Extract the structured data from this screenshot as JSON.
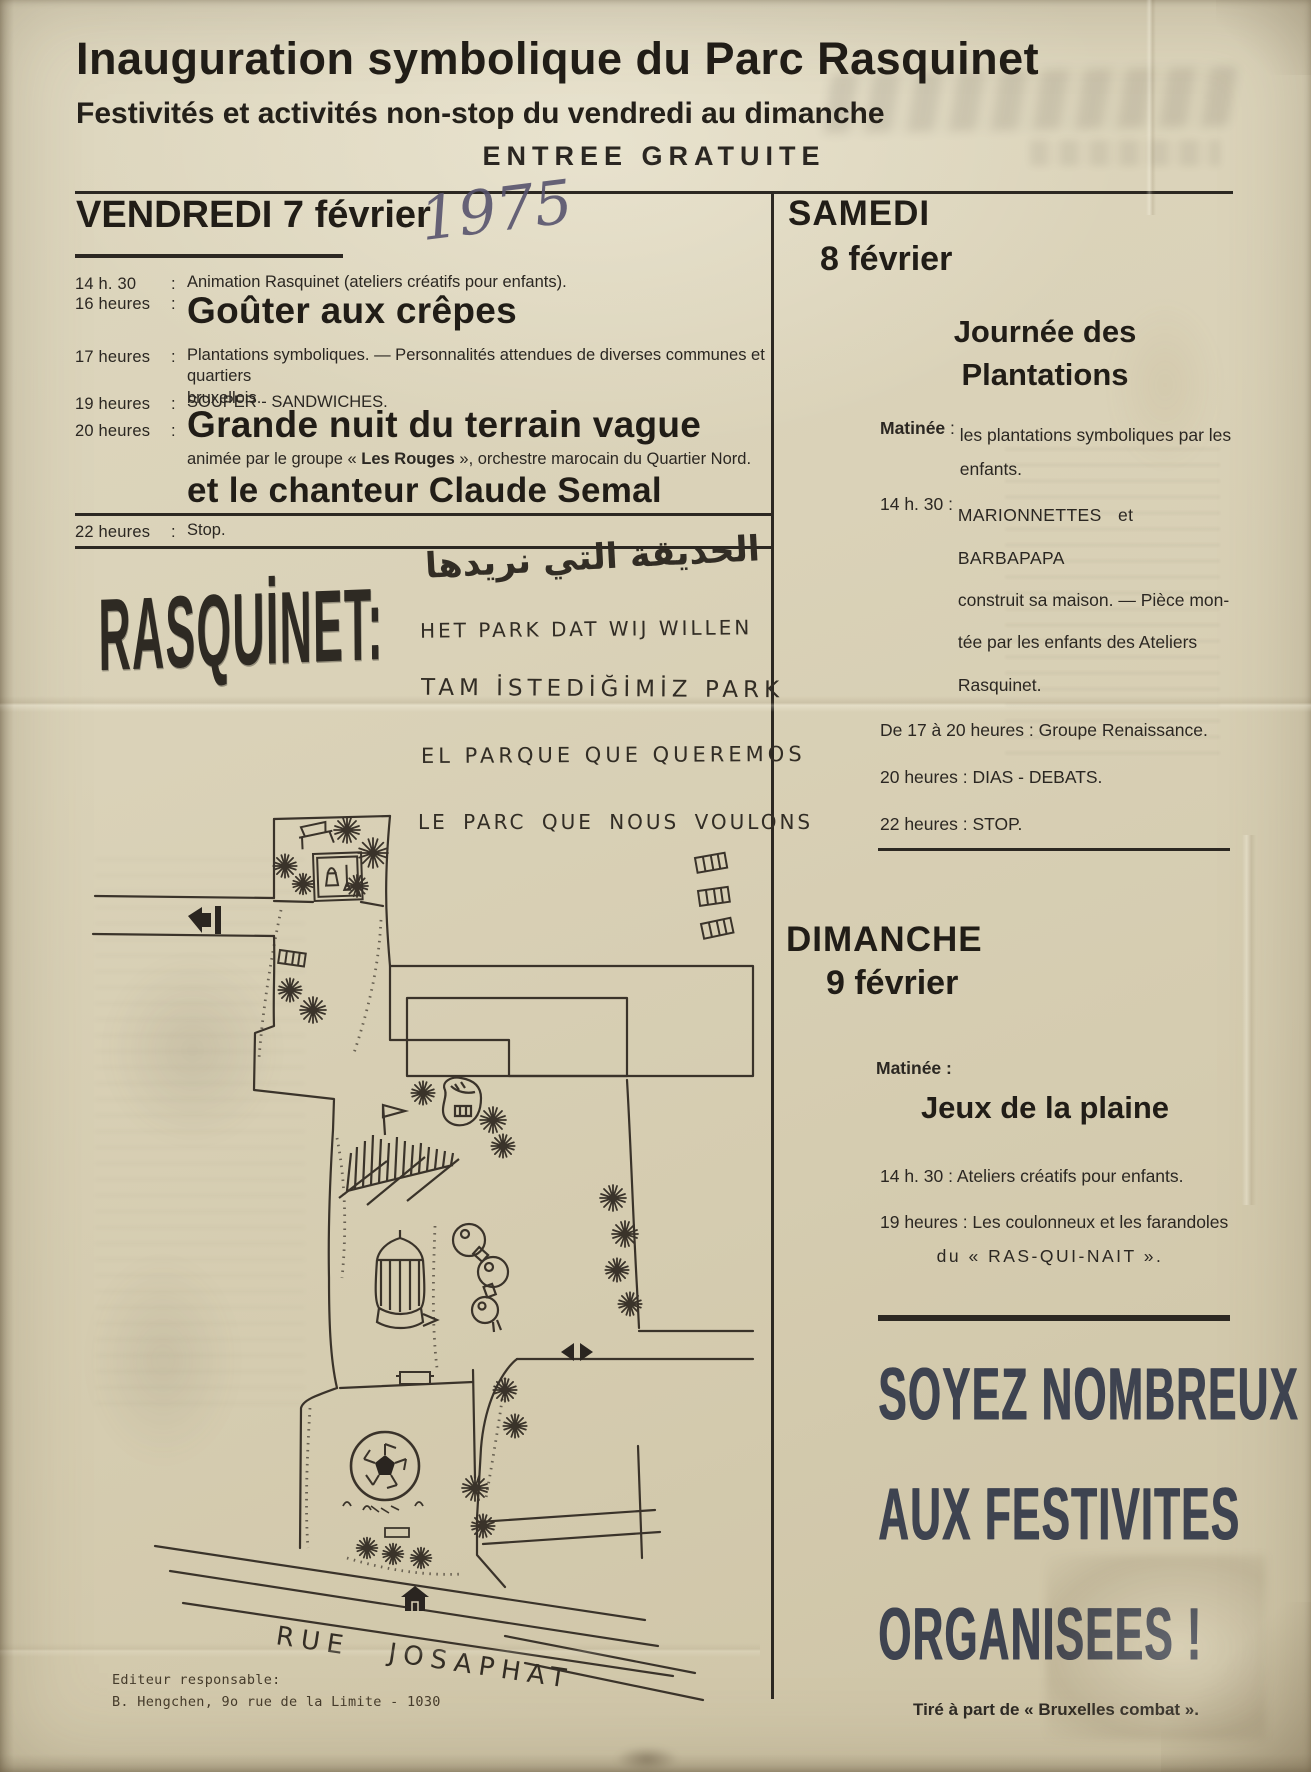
{
  "header": {
    "title": "Inauguration symbolique du Parc Rasquinet",
    "subtitle": "Festivités et activités non-stop du vendredi au dimanche",
    "free_entry": "ENTREE GRATUITE"
  },
  "friday": {
    "heading": "VENDREDI 7 février",
    "year_handwritten": "1975",
    "items": [
      {
        "time": "14 h. 30",
        "sep": ":",
        "text": "Animation Rasquinet (ateliers créatifs pour enfants)."
      },
      {
        "time": "16 heures",
        "sep": ":",
        "big": "Goûter aux crêpes"
      },
      {
        "time": "17 heures",
        "sep": ":",
        "line1": "Plantations symboliques. — Personnalités attendues de diverses communes et quartiers",
        "line2": "bruxellois."
      },
      {
        "time": "19 heures",
        "sep": ":",
        "text": "SOUPER - SANDWICHES."
      },
      {
        "time": "20 heures",
        "sep": ":",
        "big1": "Grande nuit du terrain vague",
        "sub_pre": "animée par le groupe « ",
        "sub_bold": "Les Rouges",
        "sub_post": " », orchestre marocain du Quartier Nord.",
        "big2": "et le chanteur Claude Semal"
      },
      {
        "time": "22 heures",
        "sep": ":",
        "text": "Stop."
      }
    ]
  },
  "slogans": {
    "logo": "RASQUİNET:",
    "arabic": "الحديقة التي نريدها",
    "dutch": "HET PARK DAT WIJ WILLEN",
    "turkish": "TAM İSTEDİĞİMİZ PARK",
    "spanish": "EL PARQUE QUE QUEREMOS",
    "french": "LE PARC QUE NOUS VOULONS"
  },
  "saturday": {
    "day": "SAMEDI",
    "date": "8 février",
    "title1": "Journée des",
    "title2": "Plantations",
    "entries": [
      {
        "label": "Matinée",
        "sep": " : ",
        "line0": "les plantations symboliques par les",
        "line1": "enfants."
      },
      {
        "label": "14 h. 30",
        "sep": " : ",
        "line0": "MARIONNETTES et BARBAPAPA",
        "line1": "construit sa maison. — Pièce mon-",
        "line2": "tée par les enfants des Ateliers",
        "line3": "Rasquinet."
      },
      {
        "label": "De 17 à 20 heures",
        "sep": " : ",
        "line0": "Groupe Renaissance."
      },
      {
        "label": "20 heures",
        "sep": " : ",
        "line0": "DIAS - DEBATS."
      },
      {
        "label": "22 heures",
        "sep": " : ",
        "line0": "STOP."
      }
    ]
  },
  "sunday": {
    "day": "DIMANCHE",
    "date": "9 février",
    "matinee": "Matinée :",
    "title": "Jeux de la plaine",
    "row0": "14 h. 30 : Ateliers créatifs pour enfants.",
    "row1a": "19 heures : Les coulonneux et les farandoles",
    "row1b": "du « RAS-QUI-NAIT »."
  },
  "banner": {
    "line1": "SOYEZ NOMBREUX",
    "line2": "AUX FESTIVITES",
    "line3": "ORGANISEES !",
    "footnote": "Tiré à part de « Bruxelles combat ».",
    "ink": "#3e4350"
  },
  "map": {
    "street_label": "RUE JOSAPHAT",
    "publisher_line1": "Editeur responsable:",
    "publisher_line2": "B. Hengchen, 9o rue de la Limite - 1030",
    "features": [
      "park-boundary",
      "trees",
      "bench",
      "sandbox",
      "bucket-and-shovel",
      "entrance-arrow",
      "buildings",
      "ladder-benches",
      "flag-fence",
      "shoe-sculpture",
      "aviary-gazebo",
      "sculpture-blobs",
      "football",
      "exit-arrow",
      "house",
      "street-lines"
    ]
  },
  "colors": {
    "paper": "#d8d0b6",
    "ink": "#2b2722",
    "headline": "#211d17",
    "pen": "#54506b",
    "banner_ink": "#3e4350"
  }
}
